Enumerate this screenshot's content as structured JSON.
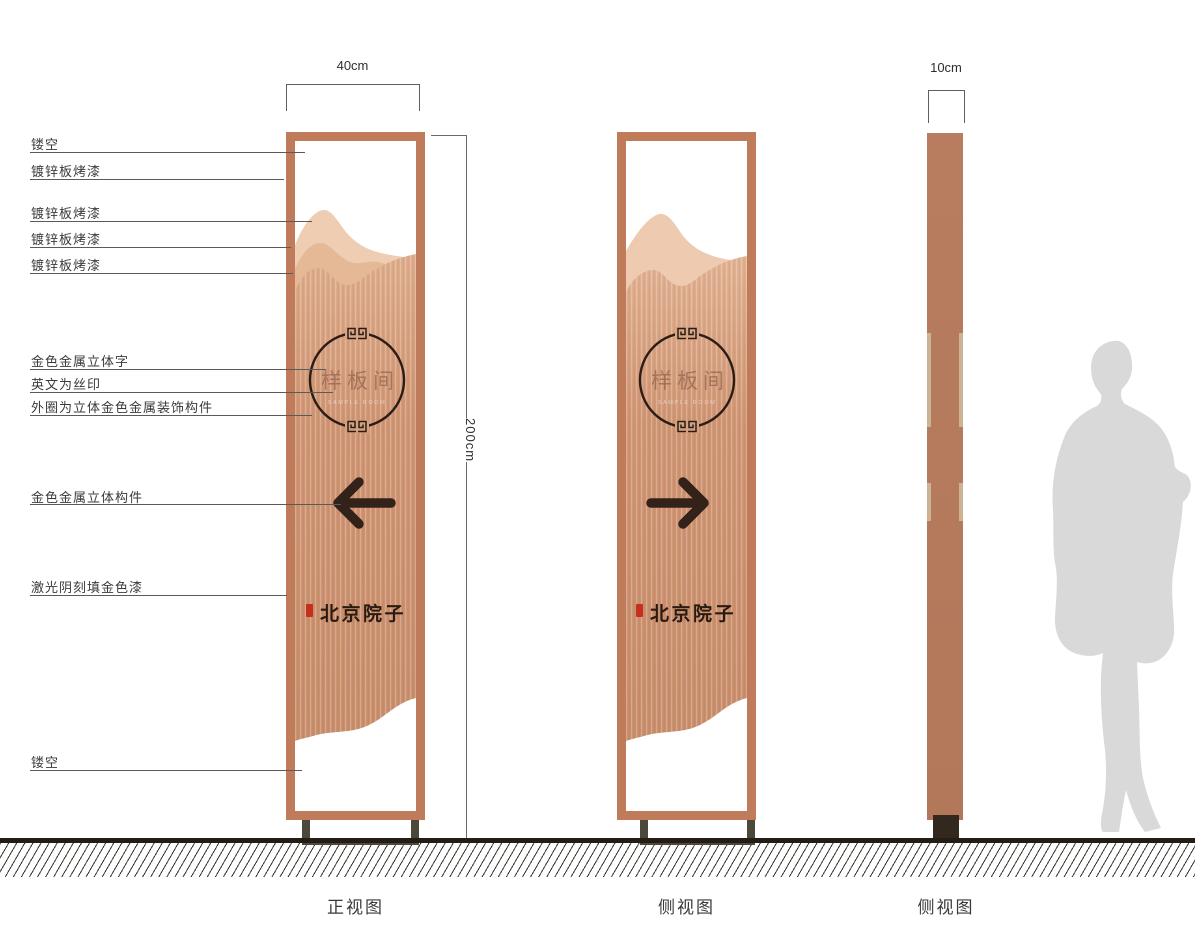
{
  "dimensions": {
    "front_width": "40cm",
    "side_width": "10cm",
    "height": "200cm"
  },
  "callouts": [
    "镂空",
    "镀锌板烤漆",
    "镀锌板烤漆",
    "镀锌板烤漆",
    "镀锌板烤漆",
    "金色金属立体字",
    "英文为丝印",
    "外圈为立体金色金属装饰构件",
    "金色金属立体构件",
    "激光阴刻填金色漆",
    "镂空"
  ],
  "sign": {
    "circle_text": "样板间",
    "circle_text_en": "SAMPLE ROOM",
    "brand_text": "北京院子",
    "front_arrow_direction": "left",
    "side_arrow_direction": "right"
  },
  "views": [
    "正视图",
    "侧视图",
    "侧视图"
  ],
  "colors": {
    "frame_copper": "#c07b5b",
    "panel_body": "#d09573",
    "mountain_light": "#eecdb2",
    "mountain_mid": "#e5b996",
    "side_column": "#b5795c",
    "side_strip": "#c9b495",
    "base_bracket": "#4c483a",
    "side_foot": "#33281e",
    "ground": "#241d16",
    "silhouette": "#d9d9d9",
    "seal_red": "#c5301e",
    "arrow_dark": "#32221a",
    "circle_stroke": "#2b1d15"
  }
}
